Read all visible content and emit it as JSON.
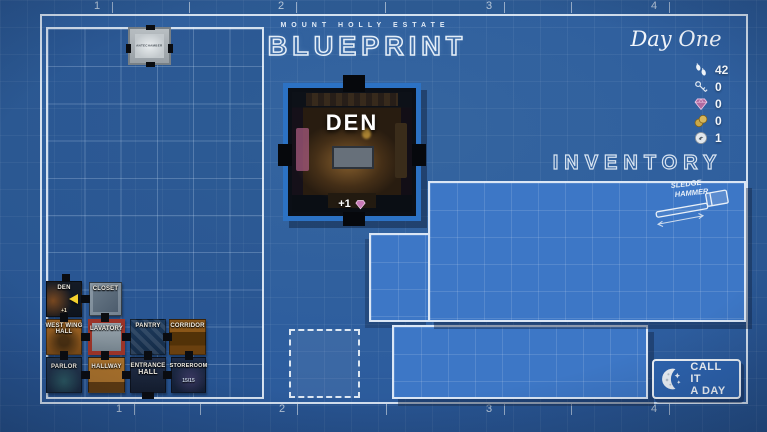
{
  "header": {
    "estate": "MOUNT HOLLY ESTATE",
    "title": "BLUEPRINT",
    "day": "Day One"
  },
  "resources": [
    {
      "name": "steps",
      "value": "42"
    },
    {
      "name": "keys",
      "value": "0"
    },
    {
      "name": "gems",
      "value": "0"
    },
    {
      "name": "coins",
      "value": "0"
    },
    {
      "name": "tokens",
      "value": "1"
    }
  ],
  "inventory": {
    "title": "INVENTORY",
    "items": [
      {
        "name": "sledge-hammer",
        "label_line1": "SLEDGE",
        "label_line2": "HAMMER"
      }
    ]
  },
  "room_card": {
    "name": "DEN",
    "reward": "+1"
  },
  "board": {
    "antechamber": "ANTECHAMBER",
    "rooms": [
      {
        "id": "den",
        "line1": "DEN",
        "line2": "",
        "sub": "+1"
      },
      {
        "id": "closet",
        "line1": "CLOSET",
        "line2": "",
        "sub": ""
      },
      {
        "id": "west-wing-hall",
        "line1": "WEST WING",
        "line2": "HALL",
        "sub": ""
      },
      {
        "id": "lavatory",
        "line1": "LAVATORY",
        "line2": "",
        "sub": ""
      },
      {
        "id": "pantry",
        "line1": "PANTRY",
        "line2": "",
        "sub": ""
      },
      {
        "id": "corridor",
        "line1": "CORRIDOR",
        "line2": "",
        "sub": ""
      },
      {
        "id": "parlor",
        "line1": "PARLOR",
        "line2": "",
        "sub": ""
      },
      {
        "id": "hallway",
        "line1": "HALLWAY",
        "line2": "",
        "sub": ""
      },
      {
        "id": "entrance-hall",
        "line1": "ENTRANCE",
        "line2": "HALL",
        "sub": ""
      },
      {
        "id": "store-room",
        "line1": "STOREROOM",
        "line2": "",
        "sub": "15/15"
      }
    ]
  },
  "actions": {
    "call_line1": "CALL IT",
    "call_line2": "A DAY"
  },
  "rulers": {
    "top": [
      "1",
      "2",
      "3",
      "4"
    ],
    "bottom": [
      "1",
      "2",
      "3",
      "4"
    ]
  },
  "colors": {
    "background": "#2d5d9e",
    "panel": "#3d77c6",
    "frame": "#ebf2fa",
    "card_border": "#2c72c4",
    "gem": "#b06aa0",
    "gold": "#c9a84a",
    "player_arrow": "#f2d12e"
  }
}
